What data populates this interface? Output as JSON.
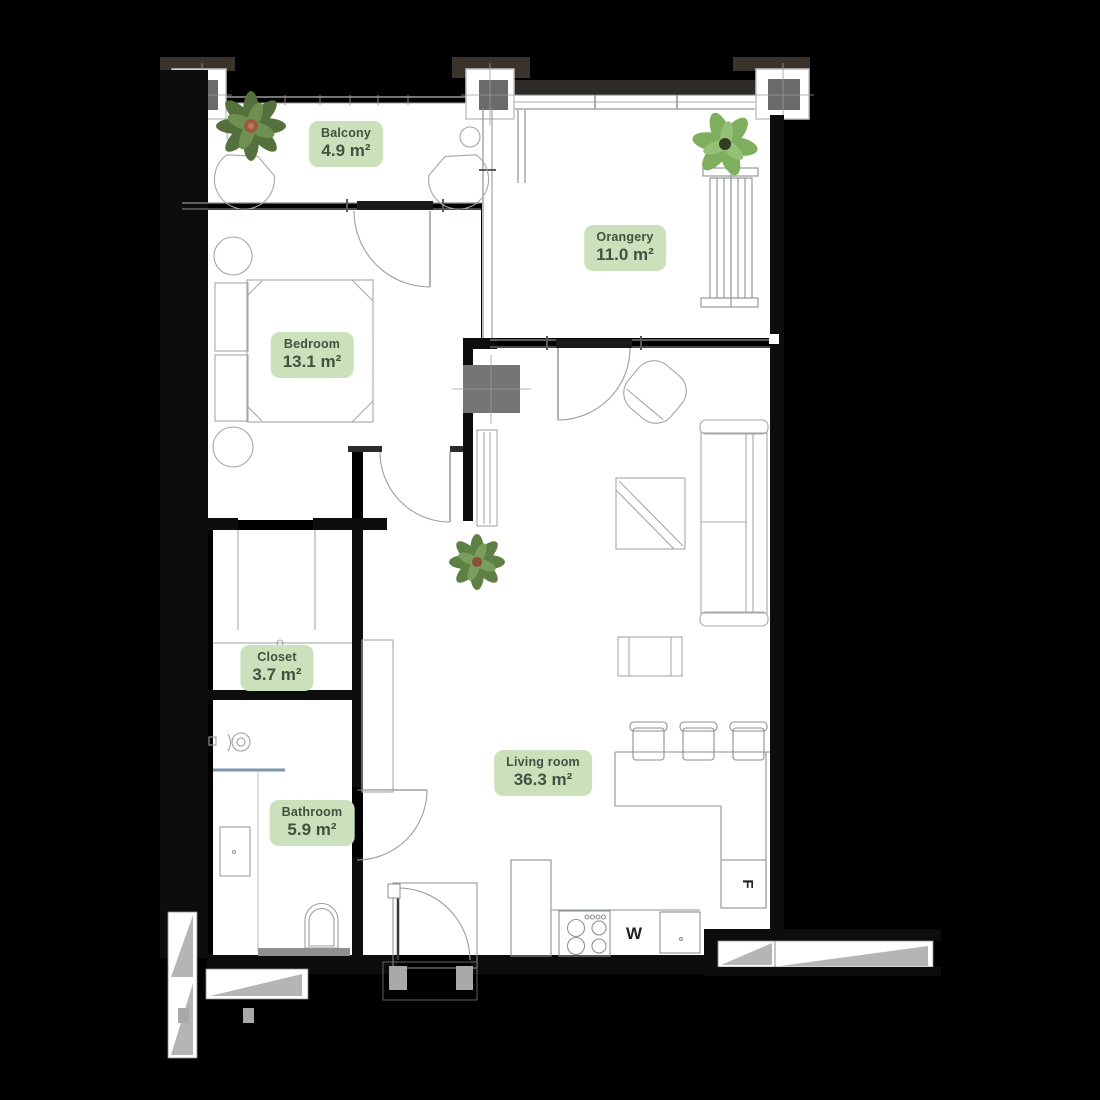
{
  "plan": {
    "rooms": [
      {
        "id": "balcony",
        "name": "Balcony",
        "area": "4.9 m²"
      },
      {
        "id": "orangery",
        "name": "Orangery",
        "area": "11.0 m²"
      },
      {
        "id": "bedroom",
        "name": "Bedroom",
        "area": "13.1 m²"
      },
      {
        "id": "closet",
        "name": "Closet",
        "area": "3.7 m²"
      },
      {
        "id": "bathroom",
        "name": "Bathroom",
        "area": "5.9 m²"
      },
      {
        "id": "living-room",
        "name": "Living room",
        "area": "36.3 m²"
      }
    ],
    "appliances": {
      "fridge_label": "F",
      "washer_label": "W"
    },
    "colors": {
      "background": "#000000",
      "floor": "#ffffff",
      "wall": "#0d0d0d",
      "label_bg": "#cbe1bc",
      "label_text": "#44513e",
      "furniture_line": "#a3a8a8",
      "shaft_gray": "#757575",
      "pillar_gray": "#6a6a6a",
      "stair_gray": "#b5b5b5",
      "shower_glass_blue": "#7d96ab",
      "plant_green": "#6d8c50"
    }
  }
}
